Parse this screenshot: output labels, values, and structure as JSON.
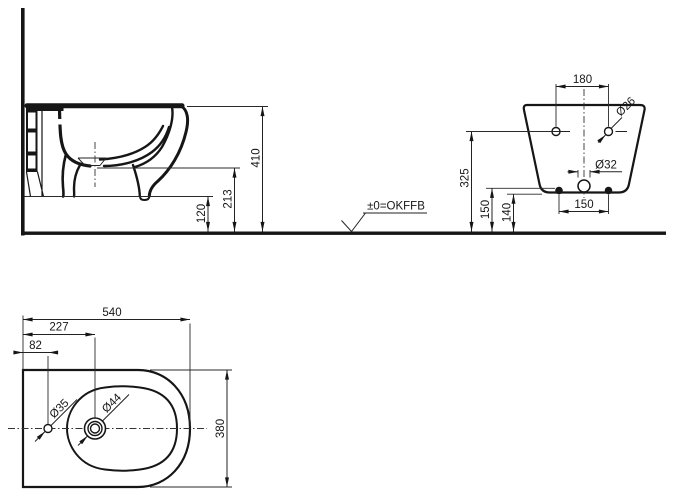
{
  "level": {
    "label": "±0=OKFFB"
  },
  "side_view": {
    "dim_height_rim": "410",
    "dim_height_bowl": "213",
    "dim_height_underside": "120"
  },
  "back_view": {
    "dim_hole_spacing": "180",
    "dim_hole_dia": "Ø26",
    "dim_drain_dia": "Ø32",
    "dim_fixing_spacing": "150",
    "dim_height_holes": "325",
    "dim_height_fixings": "150",
    "dim_height_bottom": "140"
  },
  "top_view": {
    "dim_length": "540",
    "dim_tap_offset": "227",
    "dim_hole_offset": "82",
    "dim_width": "380",
    "dim_hole_dia": "Ø35",
    "dim_tap_dia": "Ø44"
  }
}
